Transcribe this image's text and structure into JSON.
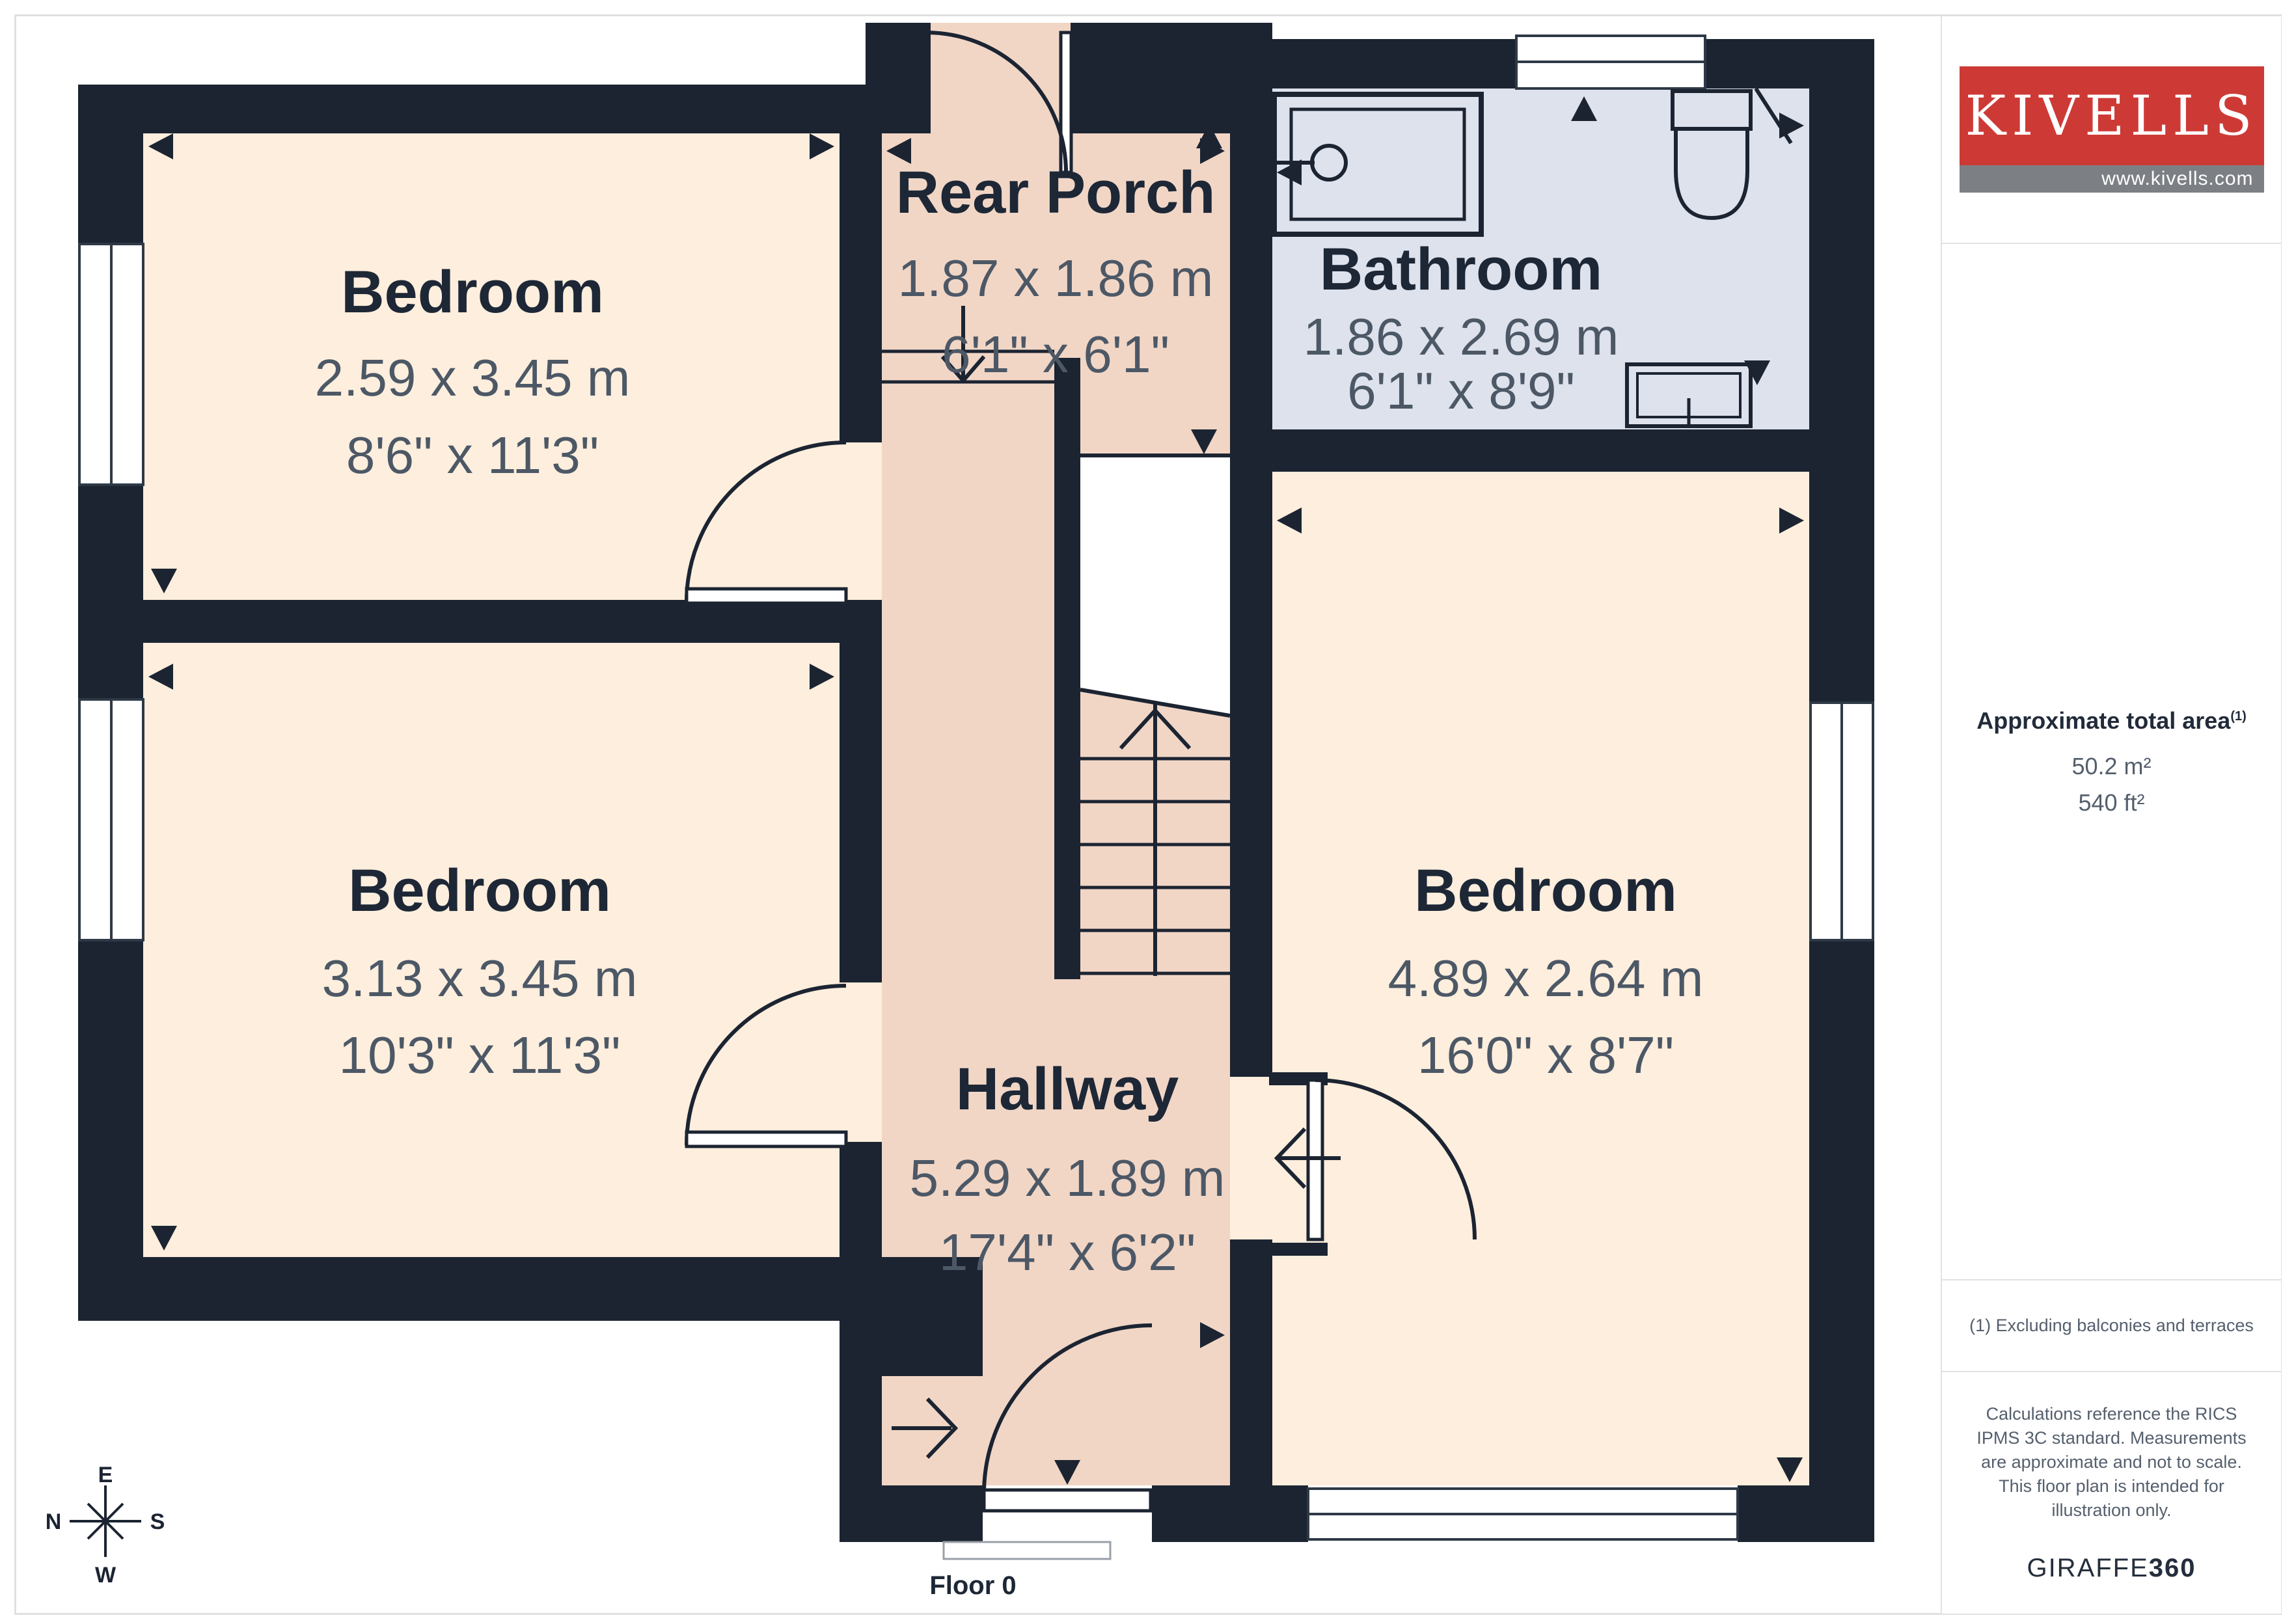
{
  "floorplan": {
    "floor_label": "Floor 0",
    "rooms": [
      {
        "name": "Bedroom",
        "metric": "2.59 x 3.45 m",
        "imperial": "8'6\" x 11'3\""
      },
      {
        "name": "Bedroom",
        "metric": "3.13 x 3.45 m",
        "imperial": "10'3\" x 11'3\""
      },
      {
        "name": "Bedroom",
        "metric": "4.89 x 2.64 m",
        "imperial": "16'0\" x 8'7\""
      },
      {
        "name": "Rear Porch",
        "metric": "1.87 x 1.86 m",
        "imperial": "6'1\" x 6'1\""
      },
      {
        "name": "Bathroom",
        "metric": "1.86 x 2.69 m",
        "imperial": "6'1\" x 8'9\""
      },
      {
        "name": "Hallway",
        "metric": "5.29 x 1.89 m",
        "imperial": "17'4\" x 6'2\""
      }
    ],
    "compass": {
      "n": "N",
      "e": "E",
      "s": "S",
      "w": "W"
    },
    "colors": {
      "wall": "#1c2432",
      "bedroom_fill": "#fdeedd",
      "hall_fill": "#f1d6c6",
      "bath_fill": "#dde2ed",
      "title_text": "#1d2736",
      "dim_text": "#4d5866"
    }
  },
  "sidebar": {
    "logo": {
      "name": "KIVELLS",
      "url": "www.kivells.com",
      "red": "#cd3a36"
    },
    "area": {
      "heading": "Approximate total area",
      "sup": "(1)",
      "metric": "50.2 m²",
      "imperial": "540 ft²"
    },
    "footnote": "(1) Excluding balconies and terraces",
    "disclaimer": "Calculations reference the RICS IPMS 3C standard. Measurements are approximate and not to scale. This floor plan is intended for illustration only.",
    "brand": {
      "name": "GIRAFFE",
      "suffix": "360"
    }
  }
}
